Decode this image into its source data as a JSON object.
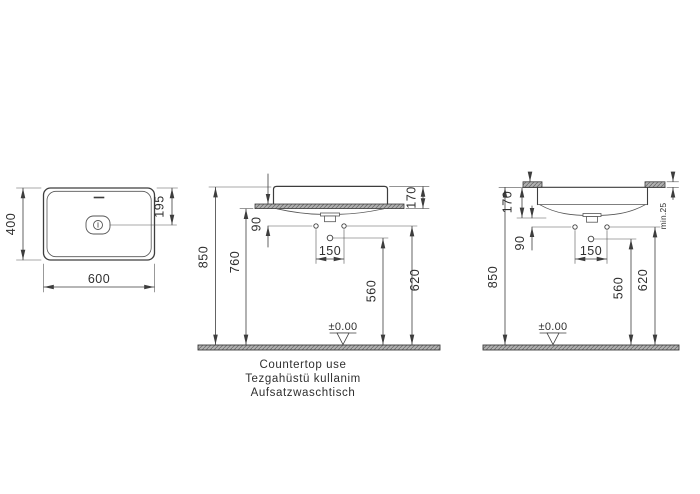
{
  "drawing_title": "Washbasin technical drawing",
  "views": {
    "plan": {
      "width": "600",
      "height": "400",
      "tap_hole_offset": "195"
    },
    "front": {
      "overall_height": "850",
      "counter_height": "760",
      "hole_offset": "90",
      "basin_height": "170",
      "hole_spacing": "150",
      "mixer_hole_height": "560",
      "side_hole_height": "620",
      "datum": "±0.00"
    },
    "side": {
      "basin_height": "170",
      "hole_offset": "90",
      "overall_height": "850",
      "hole_spacing": "150",
      "mixer_hole_height": "560",
      "side_hole_height": "620",
      "min_counter_thickness": "min.25",
      "datum": "±0.00"
    }
  },
  "caption": {
    "line1": "Countertop use",
    "line2": "Tezgahüstü kullanim",
    "line3": "Aufsatzwaschtisch"
  },
  "colors": {
    "line": "#3d3d3d",
    "thin_line": "#555555",
    "hatch_fill": "#b2b2b2",
    "hatch_line": "#6e6e6e",
    "background": "#ffffff"
  }
}
